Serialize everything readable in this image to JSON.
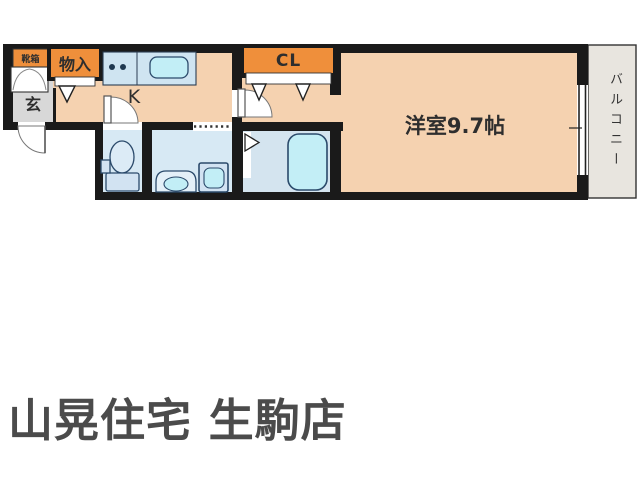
{
  "floor_plan": {
    "rooms": {
      "shoe_box_label": "靴箱",
      "storage_label": "物入",
      "genkan_label": "玄",
      "kitchen_label": "K",
      "closet_label": "CL",
      "western_room_label": "洋室9.7帖",
      "balcony_label": "バルコニー"
    },
    "fixtures": [
      "kitchen-counter",
      "stove-burners",
      "kitchen-sink",
      "toilet",
      "vanity-sink",
      "washing-machine",
      "bathtub"
    ],
    "palette": {
      "floor_peach": "#f5d2b0",
      "wet_area_blue": "#d7e9f4",
      "fixture_cyan": "#c2eef6",
      "closet_orange": "#ef8f3b",
      "genkan_gray": "#d8d8d8",
      "balcony_gray": "#e8e5df",
      "wall_black": "#1a1a1a",
      "fixture_outline": "#2b4a6b"
    }
  },
  "footer": {
    "store_name": "山晃住宅 生駒店"
  }
}
